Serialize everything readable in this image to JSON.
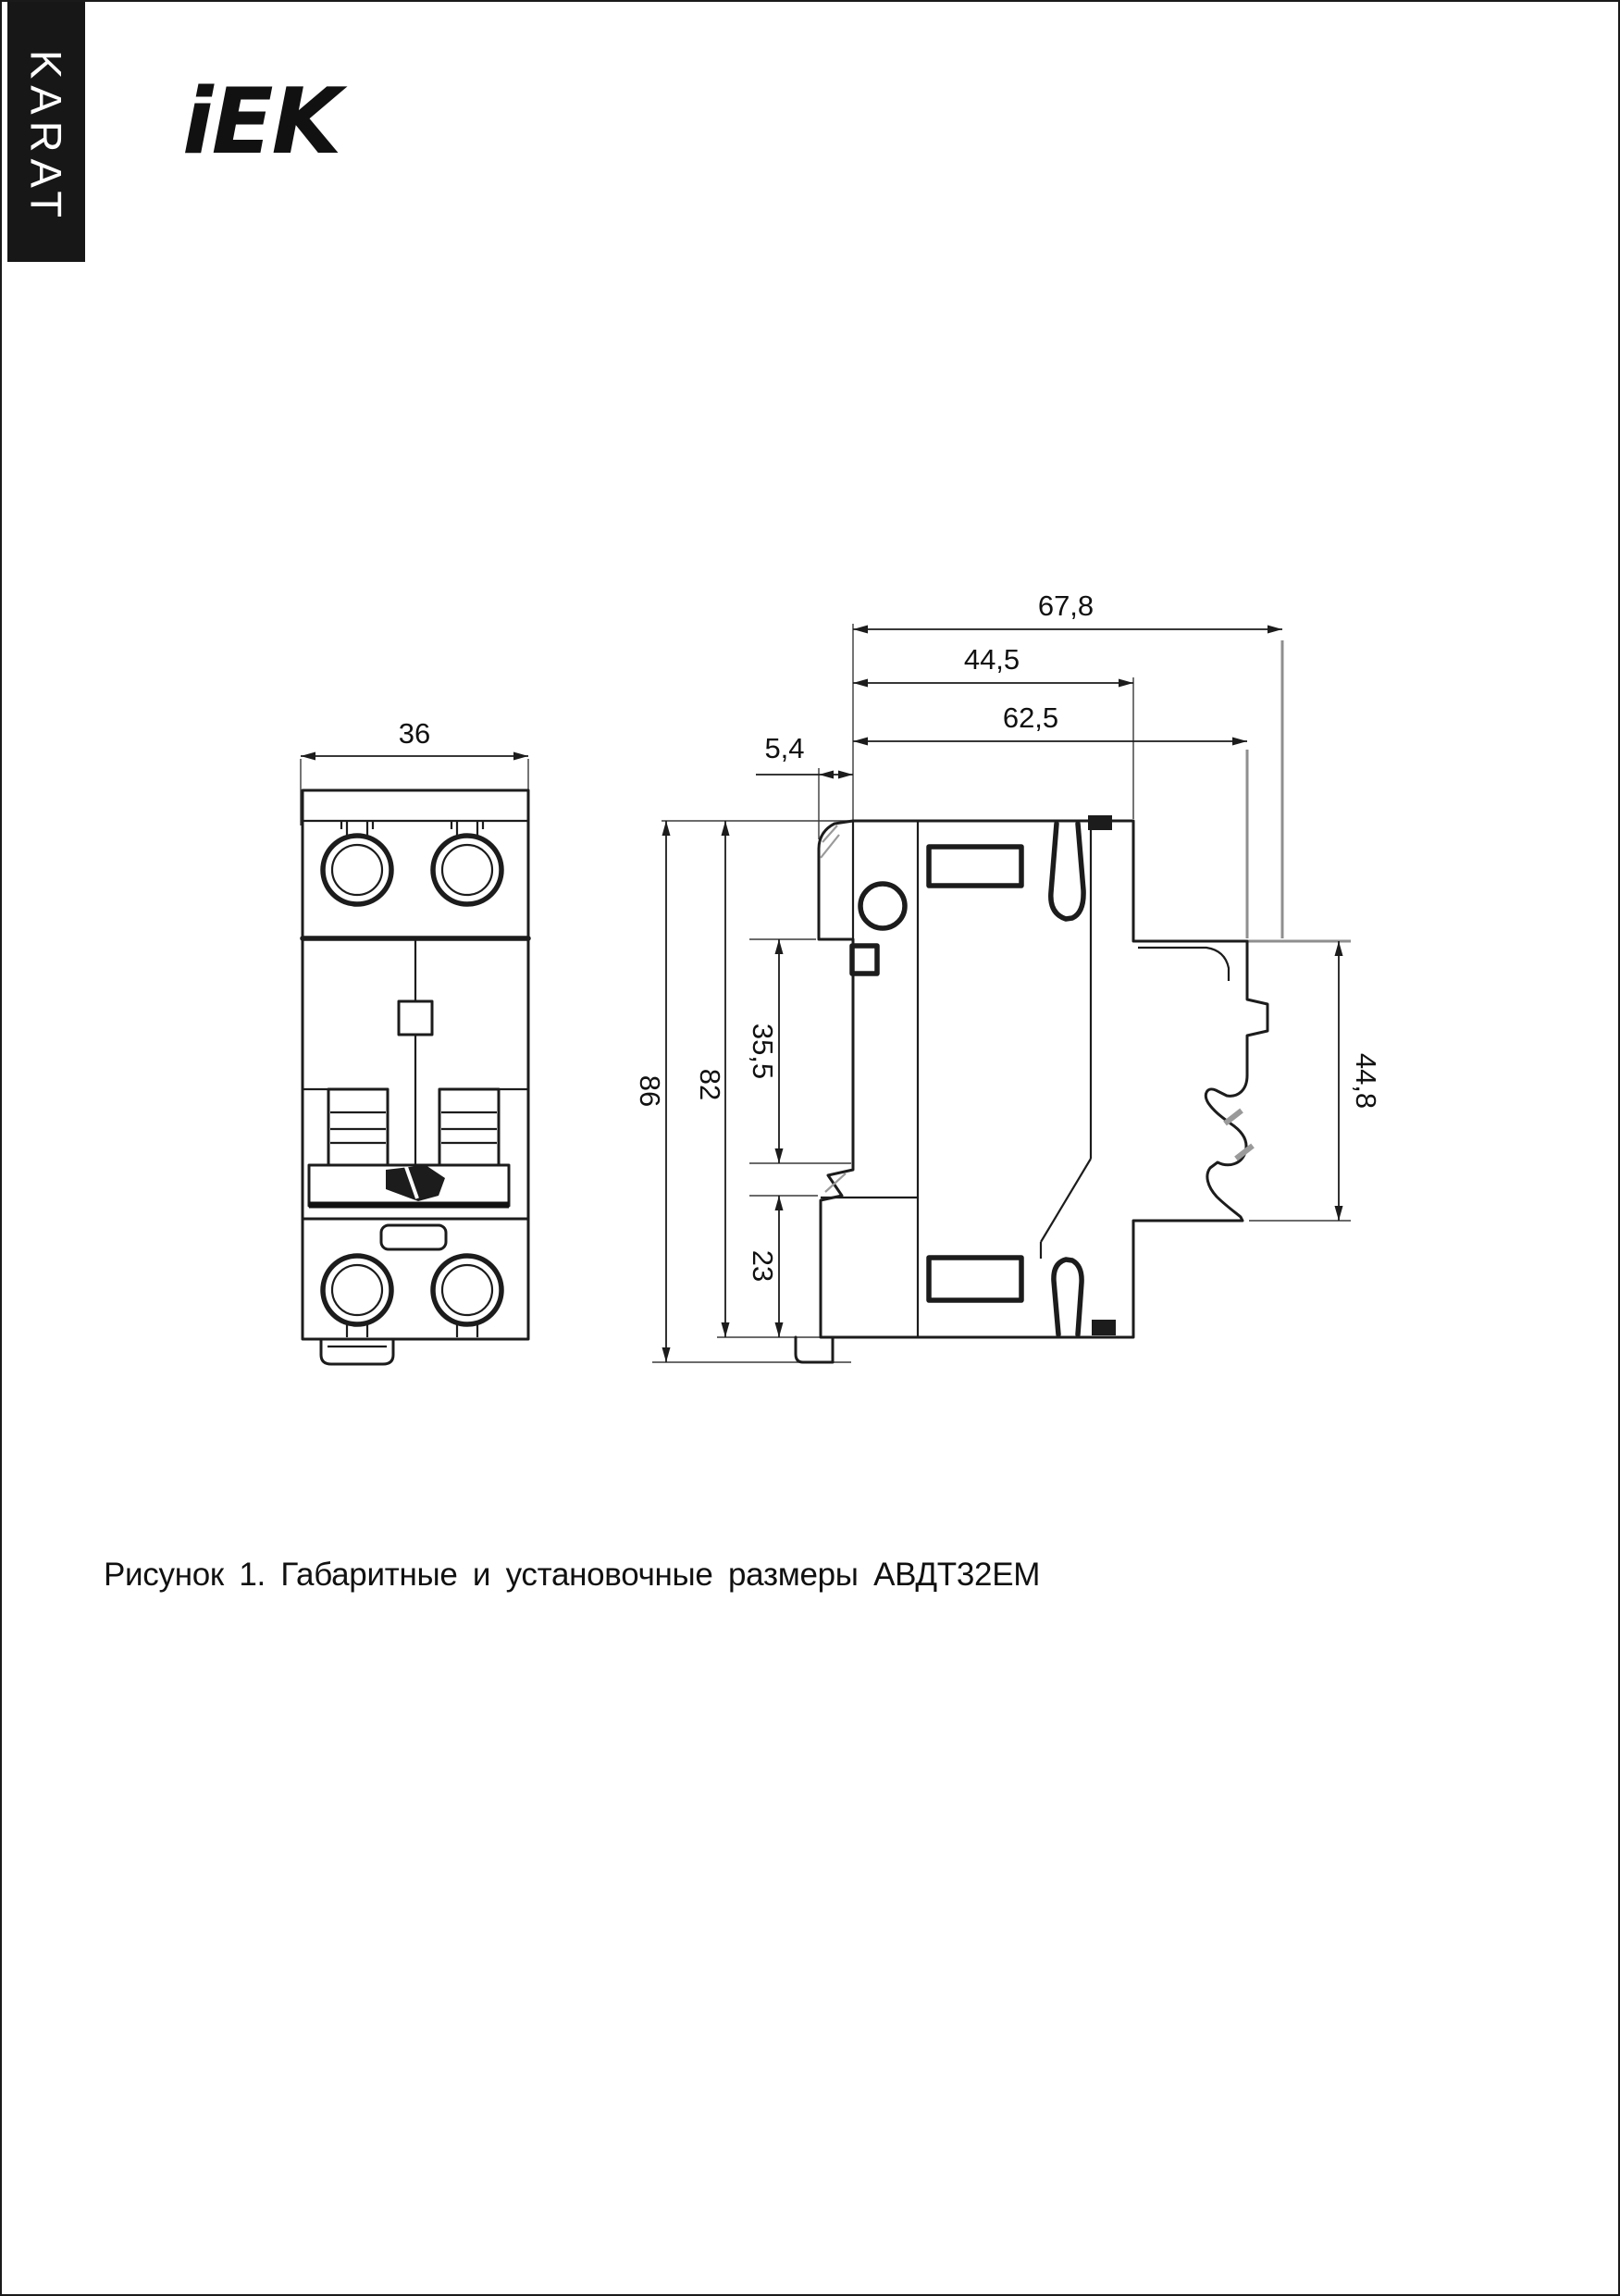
{
  "brand": {
    "sidebar_text": "KARAT",
    "logo_text": "iEK"
  },
  "figure": {
    "caption": "Рисунок 1. Габаритные и установочные размеры АВДТ32ЕМ",
    "product": "АВДТ32ЕМ",
    "front_view": {
      "dims": {
        "width": "36"
      }
    },
    "side_view": {
      "dims": {
        "overall_depth": "67,8",
        "body_depth": "44,5",
        "din_depth": "62,5",
        "handle_protrusion": "5,4",
        "overall_height": "86",
        "body_height": "82",
        "mid_height": "35,5",
        "lower_height": "23",
        "din_height": "44,8"
      }
    }
  },
  "colors": {
    "line": "#1c1c1c",
    "extension_gray": "#8f8f8f",
    "sidebar_bg": "#171717",
    "page_bg": "#ffffff"
  }
}
